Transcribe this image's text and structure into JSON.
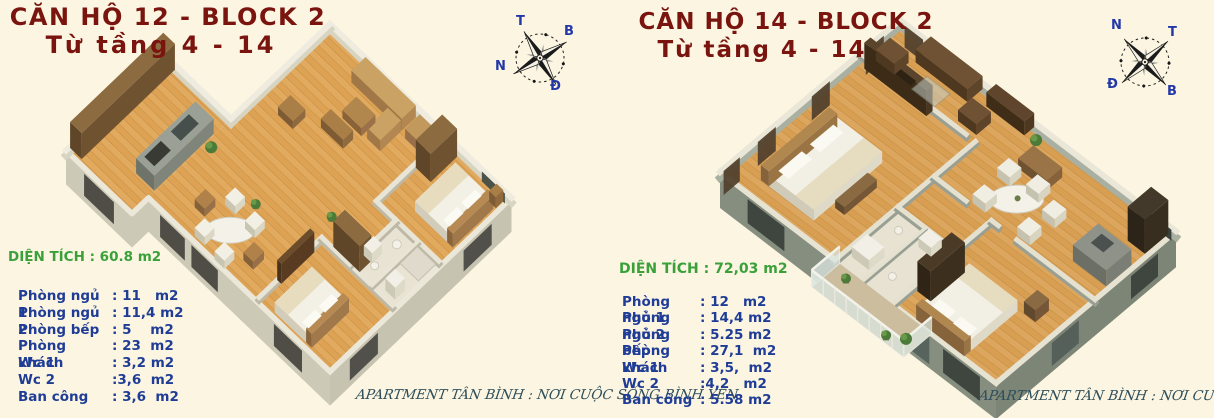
{
  "page": {
    "background": "#fcf5e1"
  },
  "panels": [
    {
      "id": "can-ho-12",
      "title": "CĂN HỘ 12 - BLOCK 2",
      "subtitle": "Từ tầng 4 - 14",
      "area_label": "DIỆN TÍCH : 60.8 m2",
      "compass": {
        "top": "T",
        "right": "B",
        "left": "N",
        "bottom": "Đ"
      },
      "rooms": [
        {
          "label": "Phòng ngủ 1",
          "value": ": 11   m2"
        },
        {
          "label": "Phòng ngủ 2",
          "value": ": 11,4 m2"
        },
        {
          "label": "Phòng bếp",
          "value": ": 5    m2"
        },
        {
          "label": "Phòng khách",
          "value": ": 23  m2"
        },
        {
          "label": "Wc 1",
          "value": ": 3,2 m2"
        },
        {
          "label": "Wc 2",
          "value": ":3,6  m2"
        },
        {
          "label": "Ban công",
          "value": ": 3,6  m2"
        }
      ],
      "watermark": "APARTMENT TÂN BÌNH : NƠI CUỘC SỐNG BÌNH YÊN"
    },
    {
      "id": "can-ho-14",
      "title": "CĂN HỘ 14 - BLOCK  2",
      "subtitle": "Từ tầng  4 - 14",
      "area_label": "DIỆN TÍCH : 72,03 m2",
      "compass": {
        "top_left": "N",
        "top_right": "T",
        "bottom_left": "Đ",
        "bottom_right": "B"
      },
      "rooms": [
        {
          "label": "Phòng ngủ 1",
          "value": ": 12   m2"
        },
        {
          "label": "Phòng ngủ 2",
          "value": ": 14,4 m2"
        },
        {
          "label": "Phòng bếp",
          "value": ": 5.25 m2"
        },
        {
          "label": "Phòng khách",
          "value": ": 27,1  m2"
        },
        {
          "label": "Wc 1",
          "value": ": 3,5,  m2"
        },
        {
          "label": "Wc 2",
          "value": ":4,2   m2"
        },
        {
          "label": "Ban công",
          "value": ": 5.58 m2"
        }
      ],
      "watermark": "APARTMENT TÂN BÌNH : NƠI CUỘC SỐNG BÌNH YÊN"
    }
  ],
  "colors": {
    "title": "#7a140e",
    "table_text": "#1f3d96",
    "area_text": "#3aa13a",
    "compass_label": "#2238a8",
    "watermark": "#2d4e5a",
    "background": "#fcf5e1",
    "wood_floor": "#e2aa5f",
    "walls_light": "#efecdf",
    "walls_dark_building": "#868e7f"
  }
}
